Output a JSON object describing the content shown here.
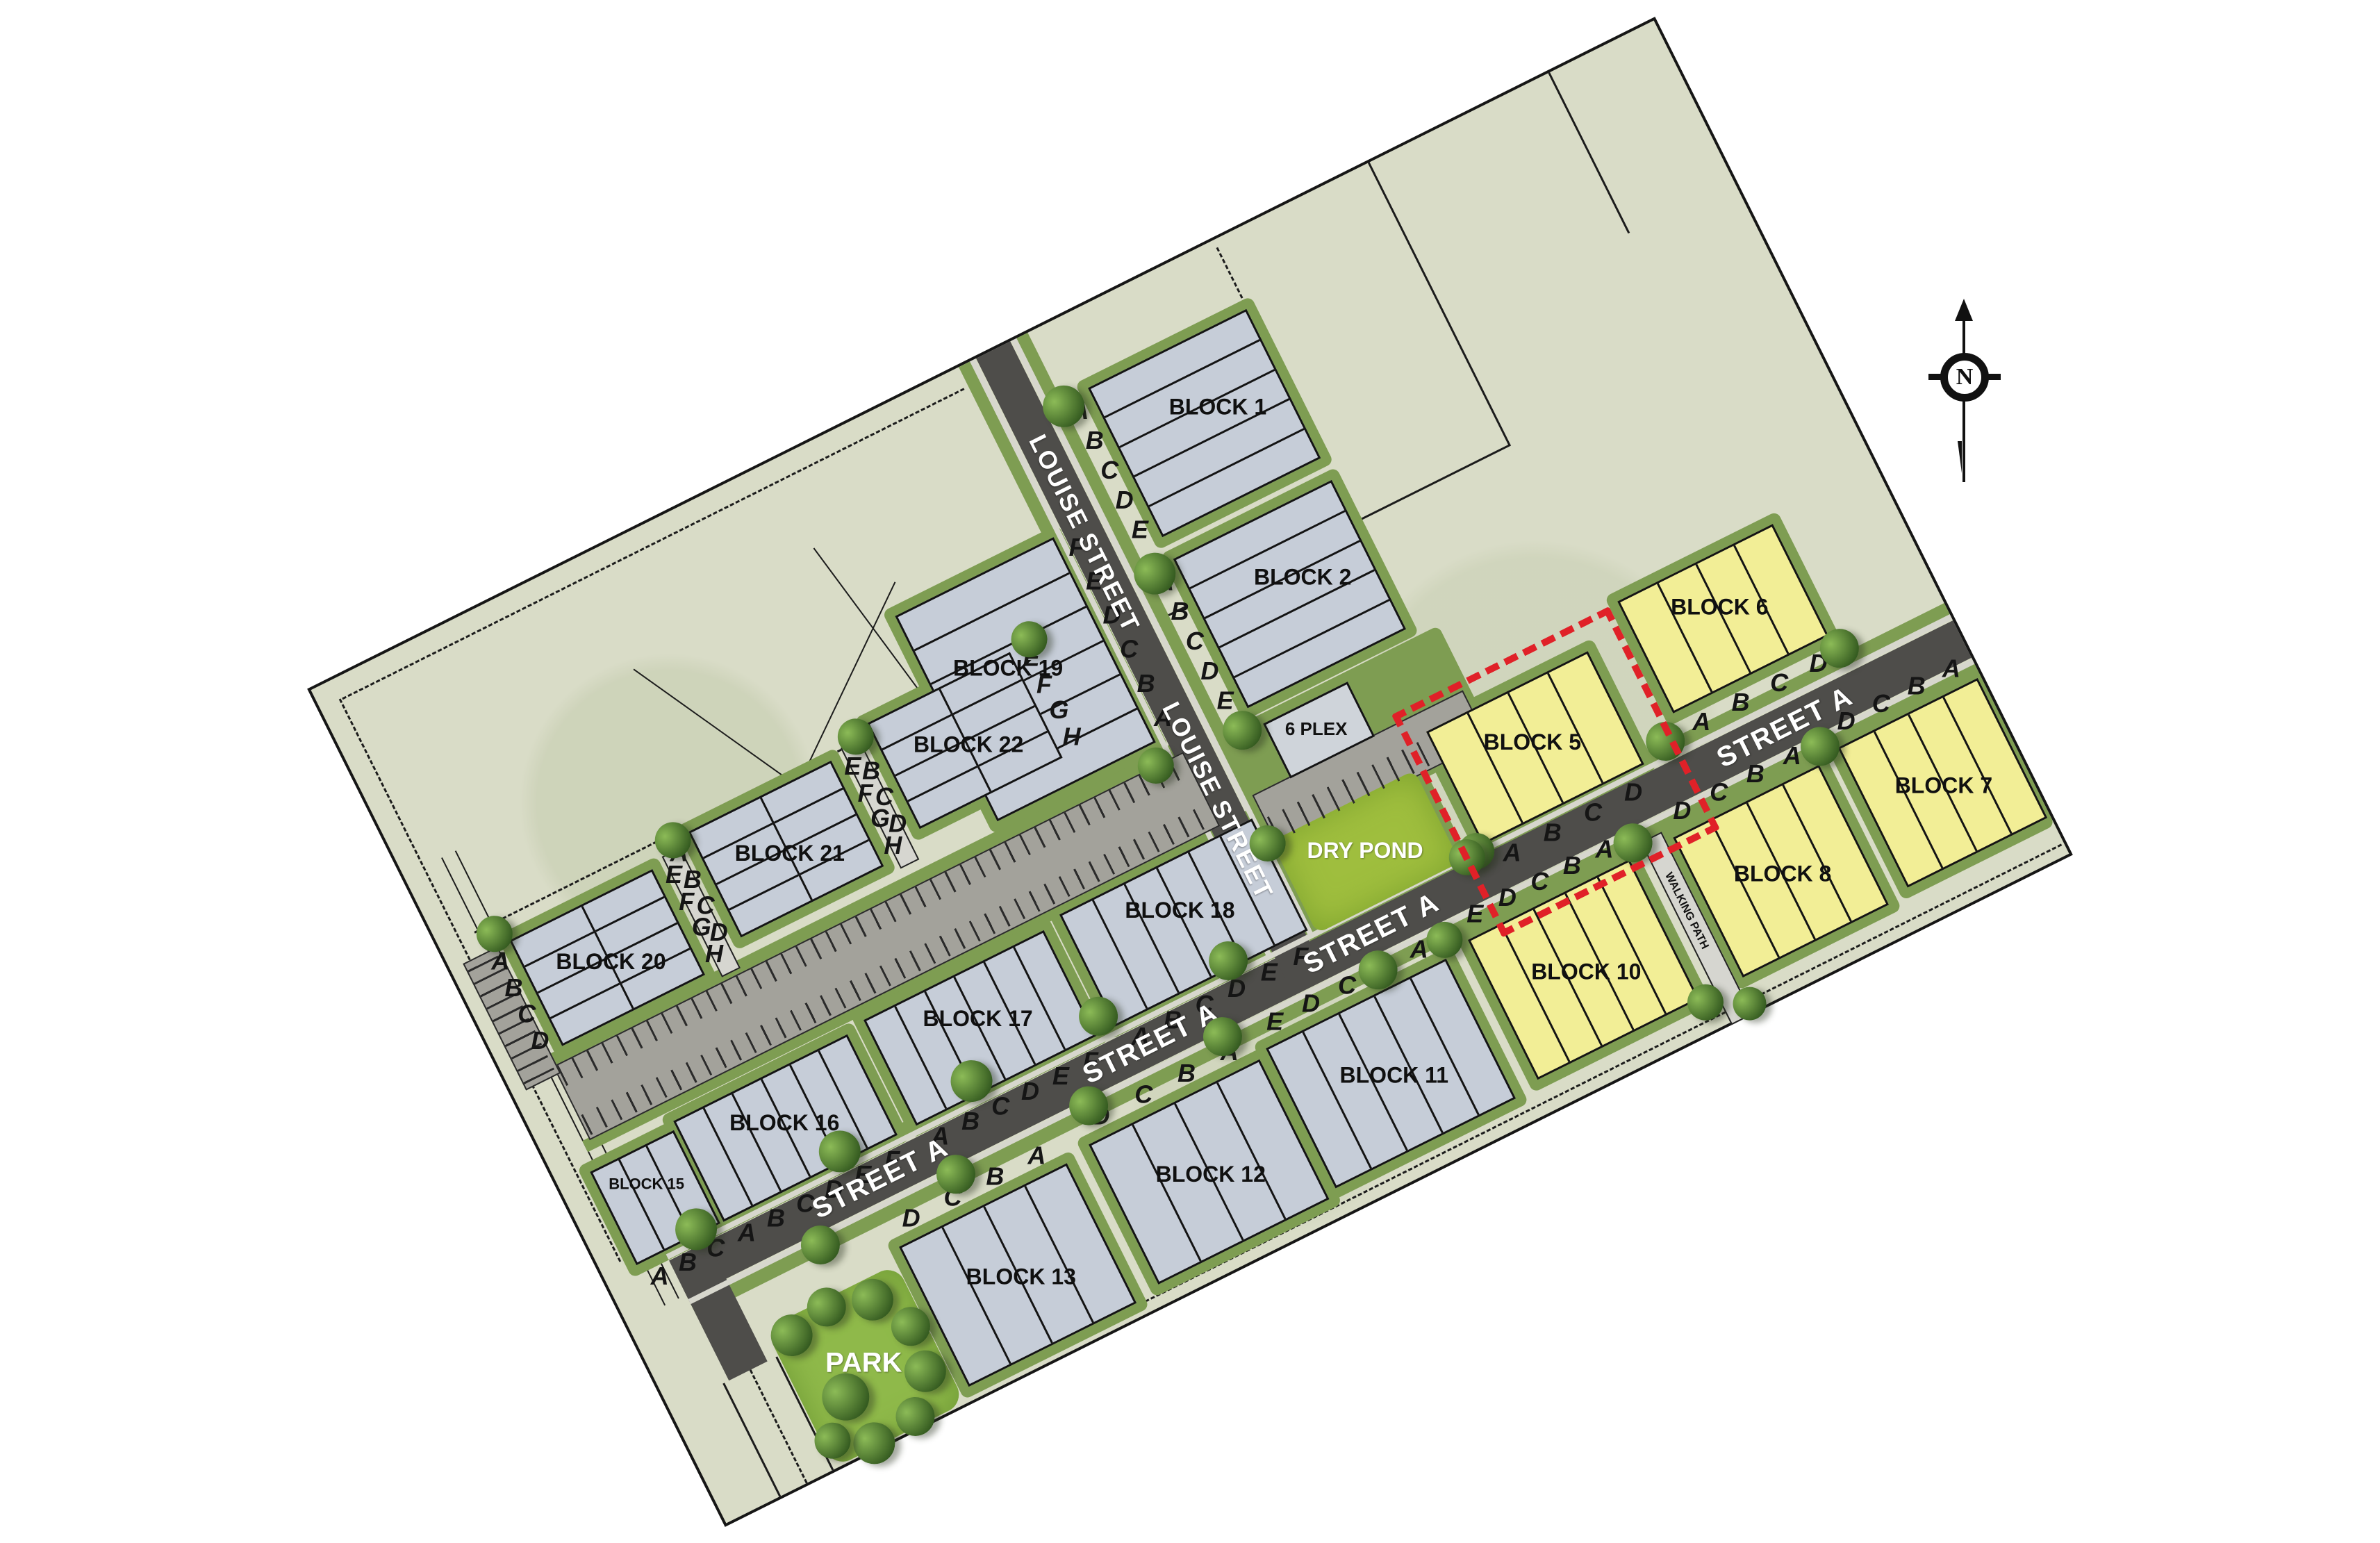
{
  "compass": {
    "label": "N"
  },
  "streets": {
    "louise": {
      "name": "LOUISE STREET",
      "label_count": 2
    },
    "street_a": {
      "name": "STREET A",
      "label_count": 4
    }
  },
  "features": {
    "dry_pond": {
      "label": "DRY POND"
    },
    "park": {
      "label": "PARK"
    },
    "six_plex": {
      "label": "6 PLEX"
    },
    "walking_path": {
      "label": "WALKING PATH"
    }
  },
  "highlight": {
    "target": "BLOCK 5",
    "style": "red dashed outline"
  },
  "colors": {
    "lot_gray": "#c6cdd8",
    "lot_yellow": "#f2ee96",
    "street": "#4e4d4a",
    "pond_green": "#9fbe3e",
    "verge_green": "#7e9d52",
    "parcel": "#d9dcc7",
    "highlight_red": "#e02128"
  },
  "blocks": [
    {
      "id": "block-1",
      "name": "BLOCK 1",
      "fill": "gray",
      "layout": "rows",
      "label_side": "left",
      "lots": [
        "A",
        "B",
        "C",
        "D",
        "E"
      ]
    },
    {
      "id": "block-2",
      "name": "BLOCK 2",
      "fill": "gray",
      "layout": "rows",
      "label_side": "left",
      "lots": [
        "A",
        "B",
        "C",
        "D",
        "E"
      ]
    },
    {
      "id": "block-5",
      "name": "BLOCK 5",
      "fill": "yellow",
      "layout": "cols",
      "label_side": "bottom",
      "lots": [
        "A",
        "B",
        "C",
        "D"
      ],
      "highlighted": true
    },
    {
      "id": "block-6",
      "name": "BLOCK 6",
      "fill": "yellow",
      "layout": "cols",
      "label_side": "bottom",
      "lots": [
        "A",
        "B",
        "C",
        "D"
      ]
    },
    {
      "id": "block-7",
      "name": "BLOCK 7",
      "fill": "yellow",
      "layout": "cols",
      "label_side": "top",
      "lots": [
        "D",
        "C",
        "B",
        "A"
      ]
    },
    {
      "id": "block-8",
      "name": "BLOCK 8",
      "fill": "yellow",
      "layout": "cols",
      "label_side": "top",
      "lots": [
        "D",
        "C",
        "B",
        "A"
      ]
    },
    {
      "id": "block-10",
      "name": "BLOCK 10",
      "fill": "yellow",
      "layout": "cols",
      "label_side": "top",
      "lots": [
        "E",
        "D",
        "C",
        "B",
        "A"
      ]
    },
    {
      "id": "block-11",
      "name": "BLOCK 11",
      "fill": "gray",
      "layout": "cols",
      "label_side": "top",
      "lots": [
        "E",
        "D",
        "C",
        "B",
        "A"
      ]
    },
    {
      "id": "block-12",
      "name": "BLOCK 12",
      "fill": "gray",
      "layout": "cols",
      "label_side": "top",
      "lots": [
        "D",
        "C",
        "B",
        "A"
      ]
    },
    {
      "id": "block-13",
      "name": "BLOCK 13",
      "fill": "gray",
      "layout": "cols",
      "label_side": "top",
      "lots": [
        "D",
        "C",
        "B",
        "A"
      ]
    },
    {
      "id": "block-15",
      "name": "BLOCK 15",
      "fill": "gray",
      "layout": "cols",
      "label_side": "bottom",
      "lots": [
        "A",
        "B",
        "C"
      ]
    },
    {
      "id": "block-16",
      "name": "BLOCK 16",
      "fill": "gray",
      "layout": "cols",
      "label_side": "bottom",
      "lots": [
        "A",
        "B",
        "C",
        "D",
        "E",
        "F"
      ]
    },
    {
      "id": "block-17",
      "name": "BLOCK 17",
      "fill": "gray",
      "layout": "cols",
      "label_side": "bottom",
      "lots": [
        "A",
        "B",
        "C",
        "D",
        "E",
        "F"
      ]
    },
    {
      "id": "block-18",
      "name": "BLOCK 18",
      "fill": "gray",
      "layout": "cols",
      "label_side": "bottom",
      "lots": [
        "A",
        "B",
        "C",
        "D",
        "E",
        "F"
      ]
    },
    {
      "id": "block-19",
      "name": "BLOCK 19",
      "fill": "gray",
      "layout": "rows",
      "label_side": "right",
      "lots": [
        "F",
        "E",
        "D",
        "C",
        "B",
        "A"
      ]
    },
    {
      "id": "block-20",
      "name": "BLOCK 20",
      "fill": "gray",
      "layout": "grid2",
      "left_lots": [
        "A",
        "B",
        "C",
        "D"
      ],
      "right_lots": [
        "E",
        "F",
        "G",
        "H"
      ]
    },
    {
      "id": "block-21",
      "name": "BLOCK 21",
      "fill": "gray",
      "layout": "grid2",
      "left_lots": [
        "A",
        "B",
        "C",
        "D"
      ],
      "right_lots": [
        "E",
        "F",
        "G",
        "H"
      ]
    },
    {
      "id": "block-22",
      "name": "BLOCK 22",
      "fill": "gray",
      "layout": "grid2",
      "left_lots": [
        "A",
        "B",
        "C",
        "D"
      ],
      "right_lots": [
        "E",
        "F",
        "G",
        "H"
      ]
    }
  ]
}
